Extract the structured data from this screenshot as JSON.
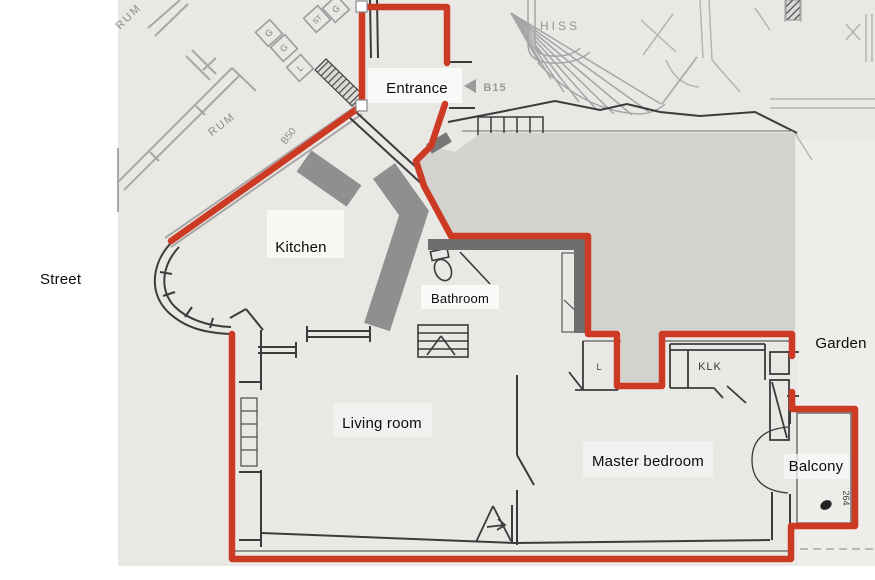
{
  "room_labels": {
    "street": "Street",
    "entrance": "Entrance",
    "kitchen": "Kitchen",
    "bathroom": "Bathroom",
    "living_room": "Living room",
    "master_bedroom": "Master bedroom",
    "garden": "Garden",
    "balcony": "Balcony"
  },
  "plan_texts": {
    "room_upper": "RUM",
    "room_lower": "RUM",
    "door_b50": "B50",
    "elevator": "HISS",
    "door_b15": "B15",
    "closet_klk": "KLK",
    "closet_l": "L",
    "balcony_number": "264",
    "storage_boxes": [
      "G",
      "ST",
      "G",
      "G",
      "L"
    ]
  },
  "colors": {
    "outline_red": "#cd3a24",
    "overlay_light_gray": "#d3d2cf",
    "annotation_mid_gray": "#8f8f8f",
    "annotation_dark_gray": "#6e6e6e",
    "paper": "#eae8e5"
  }
}
